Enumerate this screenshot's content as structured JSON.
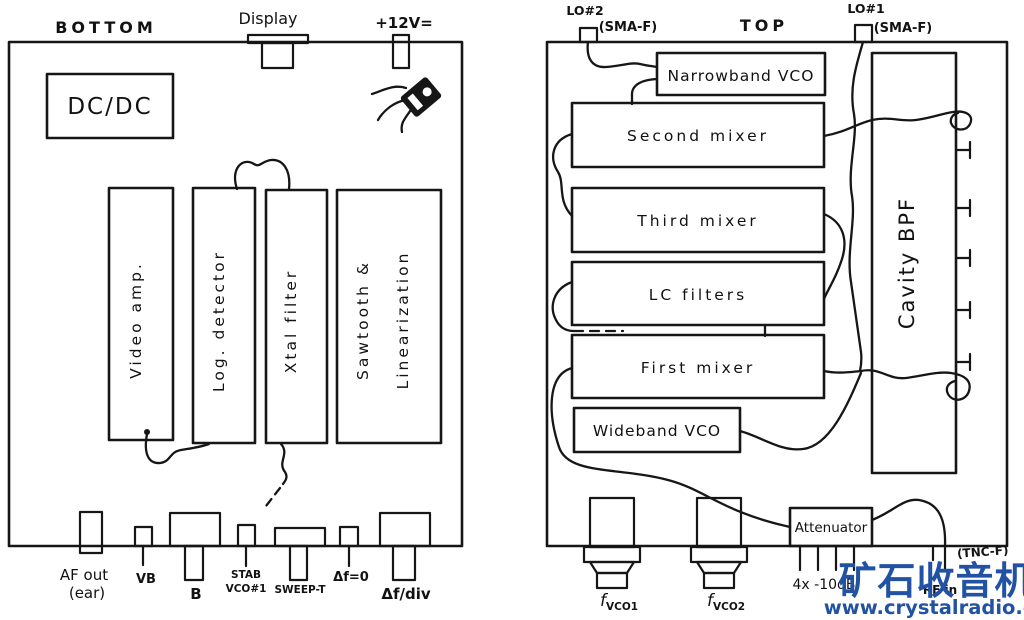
{
  "bottom_view": {
    "title": "BOTTOM",
    "display_label": "Display",
    "power_label": "+12V=",
    "blocks": {
      "dcdc": "DC/DC",
      "video_amp": "Video amp.",
      "log_detector": "Log. detector",
      "xtal_filter": "Xtal filter",
      "sawtooth_1": "Sawtooth &",
      "sawtooth_2": "Linearization"
    },
    "connectors": {
      "af_out_1": "AF out",
      "af_out_2": "(ear)",
      "vb": "VB",
      "b": "B",
      "stab_1": "STAB",
      "stab_2": "VCO#1",
      "sweep": "SWEEP-T",
      "df_zero": "Δf=0",
      "df_div": "Δf/div"
    }
  },
  "top_view": {
    "title": "TOP",
    "lo2": "LO#2",
    "lo2_conn": "(SMA-F)",
    "lo1": "LO#1",
    "lo1_conn": "(SMA-F)",
    "blocks": {
      "narrowband_vco": "Narrowband VCO",
      "second_mixer": "Second mixer",
      "third_mixer": "Third mixer",
      "lc_filters": "LC filters",
      "first_mixer": "First mixer",
      "wideband_vco": "Wideband VCO",
      "cavity_bpf": "Cavity BPF",
      "attenuator": "Attenuator"
    },
    "connectors": {
      "fvco1_f": "f",
      "fvco1_sub": "VCO1",
      "fvco2_f": "f",
      "fvco2_sub": "VCO2",
      "trimmer_label": "4x -10dB",
      "rf_conn": "(TNC-F)",
      "rf_in": "RF in"
    }
  },
  "watermark": {
    "brand": "矿石收音机",
    "url": "www.crystalradio.cn",
    "color": "#2152a3"
  }
}
